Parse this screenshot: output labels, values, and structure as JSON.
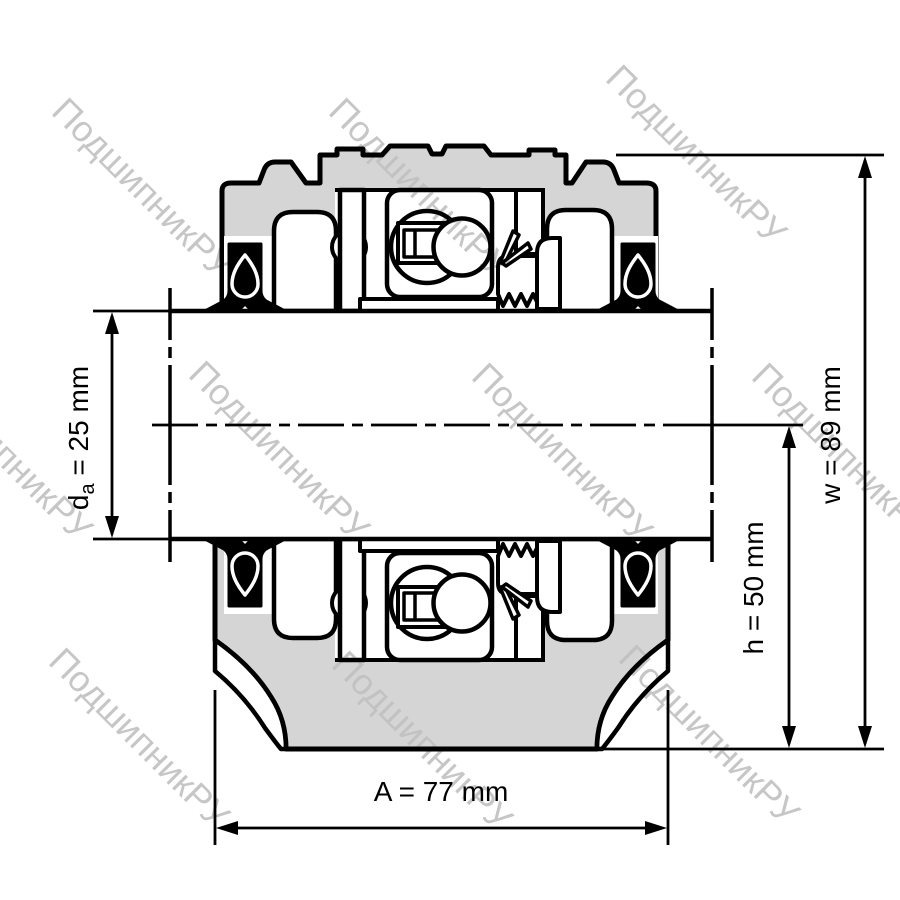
{
  "drawing_labels": {
    "da": {
      "symbol": "d",
      "subscript": "a",
      "rest": " = 25 mm"
    },
    "h": {
      "label": "h = 50 mm"
    },
    "w": {
      "label": "w = 89 mm"
    },
    "A": {
      "label": "A = 77 mm"
    }
  },
  "watermark": {
    "text": "ПодшипникРУ",
    "rotation_deg": 45,
    "font_size": 36,
    "positions": [
      {
        "x": 50,
        "y": 113
      },
      {
        "x": 327,
        "y": 113
      },
      {
        "x": 604,
        "y": 80
      },
      {
        "x": -90,
        "y": 376
      },
      {
        "x": 187,
        "y": 376
      },
      {
        "x": 470,
        "y": 378
      },
      {
        "x": 750,
        "y": 378
      },
      {
        "x": 47,
        "y": 663
      },
      {
        "x": 330,
        "y": 666
      },
      {
        "x": 617,
        "y": 660
      }
    ]
  },
  "colors": {
    "housing_fill": "#d5d5d5",
    "outline": "#000000",
    "background": "#ffffff",
    "watermark": "#c0c0c0"
  }
}
